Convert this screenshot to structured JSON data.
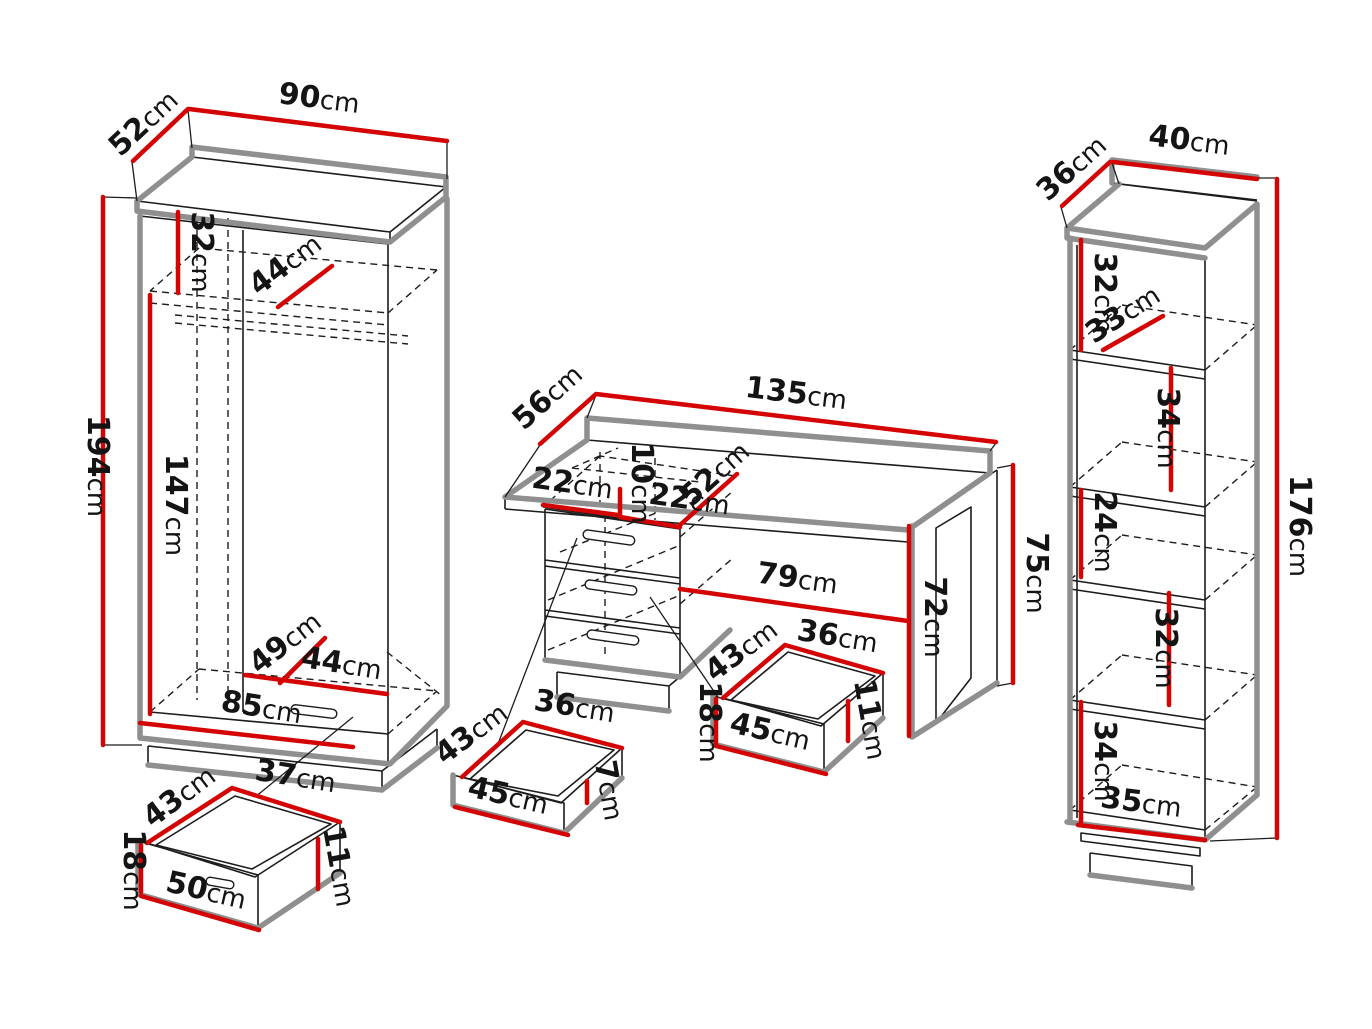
{
  "diagram": {
    "colors": {
      "dimension_red": "#d40404",
      "outline_black": "#1c1c1c",
      "shadow_gray": "#8f8f8f"
    },
    "wardrobe": {
      "depth": "52cm",
      "width": "90cm",
      "height": "194cm",
      "top_compartment_height": "32cm",
      "shelf_depth": "44cm",
      "hanging_height": "147cm",
      "base_depth": "49cm",
      "base_inner_width": "44cm",
      "drawer_front_width": "85cm",
      "drawer": {
        "depth": "43cm",
        "inner_width": "37cm",
        "front_height": "18cm",
        "front_width": "50cm",
        "inner_height": "11cm"
      }
    },
    "desk": {
      "depth": "56cm",
      "width": "135cm",
      "pedestal_top_left": "22cm",
      "niche_height": "10cm",
      "pedestal_top_right": "22cm",
      "pedestal_depth": "52cm",
      "knee_space_width": "79cm",
      "leg_inner_height": "72cm",
      "height": "75cm",
      "small_drawer": {
        "depth": "43cm",
        "inner_width": "36cm",
        "inner_height": "7cm",
        "front_width": "45cm"
      },
      "large_drawer": {
        "depth": "43cm",
        "inner_width": "36cm",
        "front_height": "18cm",
        "front_width": "45cm",
        "inner_height": "11cm"
      }
    },
    "bookcase": {
      "depth": "36cm",
      "width": "40cm",
      "height": "176cm",
      "compartment_1": "32cm",
      "shelf_depth": "33cm",
      "compartment_2": "34cm",
      "compartment_3": "24cm",
      "compartment_4": "32cm",
      "compartment_5": "34cm",
      "base_width": "35cm"
    }
  }
}
